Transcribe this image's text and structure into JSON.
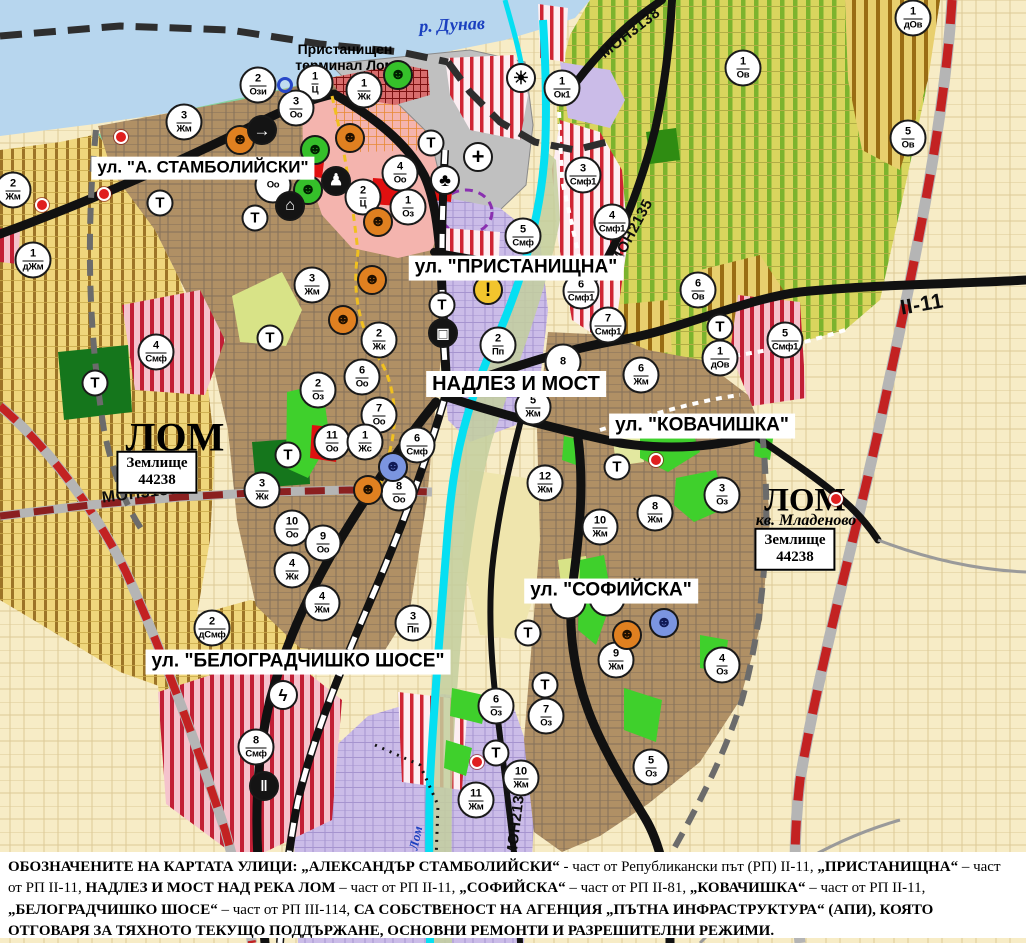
{
  "t_label": "Т",
  "colors": {
    "danube": "#b7d6ee",
    "shore_green": "#83d2a2",
    "urban_brown": "#b09065",
    "center_pink": "#f4b4ae",
    "port_gray": "#c0c0c0",
    "lavender": "#cbbce8",
    "vineyard": "#d9d55e",
    "vine_stripe": "#7cb32e",
    "villa_yellow": "#efd67c",
    "villa_stripe": "#9c7427",
    "smf_stripe_red": "#cf2433",
    "park_green": "#3fd02c",
    "dark_green": "#15761c",
    "channel_cyan": "#06dff2",
    "road_black": "#111111",
    "rep_road_red": "#c32222",
    "cream": "#f7ecc6"
  },
  "street_labels": [
    {
      "id": "stamboliyski",
      "text": "ул. \"А. СТАМБОЛИЙСКИ\"",
      "x": 203,
      "y": 168,
      "fs": 17
    },
    {
      "id": "pristanishtna",
      "text": "ул. \"ПРИСТАНИЩНА\"",
      "x": 516,
      "y": 268,
      "fs": 19
    },
    {
      "id": "nadlez-i-most",
      "text": "НАДЛЕЗ И МОСТ",
      "x": 516,
      "y": 384,
      "fs": 20
    },
    {
      "id": "kovachishka",
      "text": "ул. \"КОВАЧИШКА\"",
      "x": 702,
      "y": 426,
      "fs": 19
    },
    {
      "id": "sofiyska",
      "text": "ул. \"СОФИЙСКА\"",
      "x": 611,
      "y": 591,
      "fs": 19
    },
    {
      "id": "belogradchishko",
      "text": "ул. \"БЕЛОГРАДЧИШКО ШОСЕ\"",
      "x": 298,
      "y": 662,
      "fs": 19
    }
  ],
  "road_labels": [
    {
      "text": "МОН3139",
      "x": 140,
      "y": 494,
      "rot": -7,
      "fs": 16
    },
    {
      "text": "МОН3138",
      "x": 630,
      "y": 33,
      "rot": -38,
      "fs": 15
    },
    {
      "text": "МОН2135",
      "x": 632,
      "y": 232,
      "rot": -62,
      "fs": 15
    },
    {
      "text": "МОН2136",
      "x": 516,
      "y": 822,
      "rot": -83,
      "fs": 15
    },
    {
      "text": "II-11",
      "x": 922,
      "y": 305,
      "rot": -10,
      "fs": 21
    }
  ],
  "place_labels": [
    {
      "id": "danube-river",
      "lines": [
        "р. Дунав"
      ],
      "x": 452,
      "y": 25,
      "fs": 18,
      "serif": true,
      "italic": true,
      "blue": true,
      "rot": -3
    },
    {
      "id": "port-terminal",
      "lines": [
        "Пристанищен",
        "терминал Лом"
      ],
      "x": 345,
      "y": 57,
      "fs": 14,
      "serif": false,
      "italic": false,
      "blue": false,
      "rot": 0
    },
    {
      "id": "lom-town",
      "lines": [
        "ЛОМ"
      ],
      "x": 175,
      "y": 437,
      "fs": 40,
      "serif": true,
      "italic": false,
      "blue": false,
      "rot": 0
    },
    {
      "id": "lom-mladenovo",
      "lines": [
        "ЛОМ"
      ],
      "x": 805,
      "y": 501,
      "fs": 33,
      "serif": true,
      "italic": false,
      "blue": false,
      "rot": 0
    },
    {
      "id": "kv-mladenovo",
      "lines": [
        "кв. Младеново"
      ],
      "x": 806,
      "y": 521,
      "fs": 16,
      "serif": true,
      "italic": true,
      "blue": false,
      "rot": 0
    },
    {
      "id": "lom-river",
      "lines": [
        "Лом"
      ],
      "x": 416,
      "y": 838,
      "fs": 13,
      "serif": true,
      "italic": true,
      "blue": true,
      "rot": -78
    }
  ],
  "area_boxes": [
    {
      "lines": [
        "Землище",
        "44238"
      ],
      "x": 157,
      "y": 472
    },
    {
      "lines": [
        "Землище",
        "44238"
      ],
      "x": 795,
      "y": 549
    }
  ],
  "markers": [
    {
      "n": "2",
      "c": "Ози",
      "x": 258,
      "y": 85
    },
    {
      "n": "1",
      "c": "Ц",
      "x": 315,
      "y": 83
    },
    {
      "n": "1",
      "c": "Жк",
      "x": 364,
      "y": 90
    },
    {
      "n": "3",
      "c": "Оо",
      "x": 296,
      "y": 108
    },
    {
      "n": "3",
      "c": "Жм",
      "x": 184,
      "y": 122
    },
    {
      "n": "2",
      "c": "Жм",
      "x": 13,
      "y": 190
    },
    {
      "n": "1",
      "c": "Ок1",
      "x": 562,
      "y": 88
    },
    {
      "n": "1",
      "c": "Ов",
      "x": 743,
      "y": 68
    },
    {
      "n": "1",
      "c": "дОв",
      "x": 913,
      "y": 18
    },
    {
      "n": "5",
      "c": "Ов",
      "x": 908,
      "y": 138
    },
    {
      "n": "3",
      "c": "Смф1",
      "x": 583,
      "y": 175
    },
    {
      "n": "4",
      "c": "Смф1",
      "x": 612,
      "y": 222
    },
    {
      "n": "6",
      "c": "Смф1",
      "x": 581,
      "y": 291
    },
    {
      "n": "7",
      "c": "Смф1",
      "x": 608,
      "y": 325
    },
    {
      "n": "5",
      "c": "Смф1",
      "x": 785,
      "y": 340
    },
    {
      "n": "5",
      "c": "Смф",
      "x": 523,
      "y": 236
    },
    {
      "n": "2",
      "c": "Пп",
      "x": 498,
      "y": 345
    },
    {
      "n": "8",
      "c": "",
      "x": 563,
      "y": 362
    },
    {
      "n": "6",
      "c": "Жм",
      "x": 641,
      "y": 375
    },
    {
      "n": "5",
      "c": "Жм",
      "x": 533,
      "y": 407
    },
    {
      "n": "12",
      "c": "Жм",
      "x": 545,
      "y": 483
    },
    {
      "n": "10",
      "c": "Жм",
      "x": 600,
      "y": 527
    },
    {
      "n": "8",
      "c": "Жм",
      "x": 655,
      "y": 513
    },
    {
      "n": "3",
      "c": "Оз",
      "x": 722,
      "y": 495
    },
    {
      "n": "4",
      "c": "Оз",
      "x": 722,
      "y": 665
    },
    {
      "n": "9",
      "c": "Жм",
      "x": 616,
      "y": 660
    },
    {
      "n": "7",
      "c": "Оз",
      "x": 546,
      "y": 716
    },
    {
      "n": "6",
      "c": "Оз",
      "x": 496,
      "y": 706
    },
    {
      "n": "10",
      "c": "Жм",
      "x": 521,
      "y": 778
    },
    {
      "n": "11",
      "c": "Жм",
      "x": 476,
      "y": 800
    },
    {
      "n": "5",
      "c": "Оз",
      "x": 651,
      "y": 767
    },
    {
      "n": "6",
      "c": "Ов",
      "x": 698,
      "y": 290
    },
    {
      "n": "1",
      "c": "дОв",
      "x": 720,
      "y": 358
    },
    {
      "n": "4",
      "c": "Оо",
      "x": 400,
      "y": 173
    },
    {
      "n": "2",
      "c": "Ц",
      "x": 363,
      "y": 197
    },
    {
      "n": "1",
      "c": "Оз",
      "x": 408,
      "y": 207
    },
    {
      "n": "3",
      "c": "Жм",
      "x": 312,
      "y": 285
    },
    {
      "n": "2",
      "c": "Жк",
      "x": 379,
      "y": 340
    },
    {
      "n": "6",
      "c": "Оо",
      "x": 362,
      "y": 377
    },
    {
      "n": "2",
      "c": "Оз",
      "x": 318,
      "y": 390
    },
    {
      "n": "7",
      "c": "Оо",
      "x": 379,
      "y": 415
    },
    {
      "n": "11",
      "c": "Оо",
      "x": 332,
      "y": 442
    },
    {
      "n": "1",
      "c": "Жс",
      "x": 365,
      "y": 442
    },
    {
      "n": "6",
      "c": "Смф",
      "x": 417,
      "y": 445
    },
    {
      "n": "8",
      "c": "Оо",
      "x": 399,
      "y": 493
    },
    {
      "n": "3",
      "c": "Жк",
      "x": 262,
      "y": 490
    },
    {
      "n": "10",
      "c": "Оо",
      "x": 292,
      "y": 528
    },
    {
      "n": "9",
      "c": "Оо",
      "x": 323,
      "y": 543
    },
    {
      "n": "4",
      "c": "Жк",
      "x": 292,
      "y": 570
    },
    {
      "n": "4",
      "c": "Жм",
      "x": 322,
      "y": 603
    },
    {
      "n": "4",
      "c": "Смф",
      "x": 156,
      "y": 352
    },
    {
      "n": "1",
      "c": "дЖм",
      "x": 33,
      "y": 260
    },
    {
      "n": "2",
      "c": "дСмф",
      "x": 212,
      "y": 628
    },
    {
      "n": "3",
      "c": "Пп",
      "x": 413,
      "y": 623
    },
    {
      "n": "8",
      "c": "Смф",
      "x": 256,
      "y": 747
    },
    {
      "n": "",
      "c": "Оз",
      "x": 568,
      "y": 601
    },
    {
      "n": "",
      "c": "Оз",
      "x": 607,
      "y": 598
    },
    {
      "n": "",
      "c": "Оо",
      "x": 273,
      "y": 185
    }
  ],
  "t_markers": [
    {
      "x": 160,
      "y": 203
    },
    {
      "x": 255,
      "y": 218
    },
    {
      "x": 431,
      "y": 143
    },
    {
      "x": 442,
      "y": 305
    },
    {
      "x": 270,
      "y": 338
    },
    {
      "x": 288,
      "y": 455
    },
    {
      "x": 95,
      "y": 383
    },
    {
      "x": 720,
      "y": 327
    },
    {
      "x": 617,
      "y": 467
    },
    {
      "x": 528,
      "y": 633
    },
    {
      "x": 545,
      "y": 685
    },
    {
      "x": 496,
      "y": 753
    }
  ],
  "icons": [
    {
      "type": "mask-orange",
      "x": 240,
      "y": 140
    },
    {
      "type": "mask-orange",
      "x": 350,
      "y": 138
    },
    {
      "type": "mask-orange",
      "x": 378,
      "y": 222
    },
    {
      "type": "mask-orange",
      "x": 372,
      "y": 280
    },
    {
      "type": "mask-orange",
      "x": 343,
      "y": 320
    },
    {
      "type": "mask-orange",
      "x": 368,
      "y": 490
    },
    {
      "type": "mask-orange",
      "x": 627,
      "y": 635
    },
    {
      "type": "mask-green",
      "x": 315,
      "y": 150
    },
    {
      "type": "mask-green",
      "x": 308,
      "y": 190
    },
    {
      "type": "mask-green",
      "x": 398,
      "y": 75
    },
    {
      "type": "mask-blue",
      "x": 393,
      "y": 467
    },
    {
      "type": "mask-blue",
      "x": 664,
      "y": 623
    },
    {
      "type": "arrow",
      "x": 262,
      "y": 130
    },
    {
      "type": "monument",
      "x": 336,
      "y": 181
    },
    {
      "type": "arch",
      "x": 290,
      "y": 206
    },
    {
      "type": "clover",
      "x": 445,
      "y": 180
    },
    {
      "type": "cross",
      "x": 478,
      "y": 157
    },
    {
      "type": "sun",
      "x": 521,
      "y": 78
    },
    {
      "type": "warning",
      "x": 488,
      "y": 290
    },
    {
      "type": "truck",
      "x": 443,
      "y": 333
    },
    {
      "type": "lightning",
      "x": 283,
      "y": 695
    },
    {
      "type": "rail",
      "x": 264,
      "y": 786
    },
    {
      "type": "bluering",
      "x": 285,
      "y": 85
    }
  ],
  "red_dots": [
    {
      "x": 121,
      "y": 137
    },
    {
      "x": 42,
      "y": 205
    },
    {
      "x": 104,
      "y": 194
    },
    {
      "x": 656,
      "y": 460
    },
    {
      "x": 477,
      "y": 762
    },
    {
      "x": 836,
      "y": 499
    }
  ],
  "legend": {
    "segments": [
      {
        "t": "ОБОЗНАЧЕНИТЕ НА КАРТАТА УЛИЦИ: „АЛЕКСАНДЪР СТАМБОЛИЙСКИ“",
        "b": true
      },
      {
        "t": " - част от Републикански път (РП) II-11, ",
        "b": false
      },
      {
        "t": "„ПРИСТАНИЩНА“",
        "b": true
      },
      {
        "t": " – част от РП II-11, ",
        "b": false
      },
      {
        "t": "НАДЛЕЗ И МОСТ НАД РЕКА ЛОМ",
        "b": true
      },
      {
        "t": " – част от РП II-11, ",
        "b": false
      },
      {
        "t": "„СОФИЙСКА“",
        "b": true
      },
      {
        "t": " – част от РП II-81, ",
        "b": false
      },
      {
        "t": "„КОВАЧИШКА“",
        "b": true
      },
      {
        "t": " – част от РП II-11, ",
        "b": false
      },
      {
        "t": "„БЕЛОГРАДЧИШКО ШОСЕ“",
        "b": true
      },
      {
        "t": " – част от РП III-114, ",
        "b": false
      },
      {
        "t": "СА СОБСТВЕНОСТ НА АГЕНЦИЯ „ПЪТНА ИНФРАСТРУКТУРА“ (АПИ), КОЯТО ОТГОВАРЯ ЗА ТЯХНОТО ТЕКУЩО ПОДДЪРЖАНЕ, ОСНОВНИ РЕМОНТИ И РАЗРЕШИТЕЛНИ РЕЖИМИ.",
        "b": true
      }
    ]
  }
}
